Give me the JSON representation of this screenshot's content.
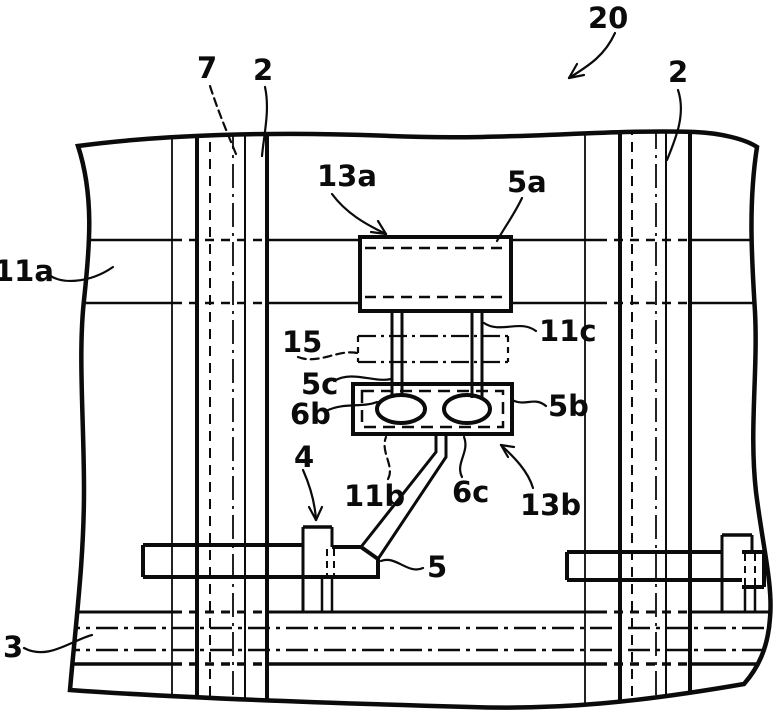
{
  "figure": {
    "kind": "patent-technical-drawing",
    "background_color": "#ffffff",
    "line_color": "#0b0b0b",
    "reference_labels": [
      {
        "text": "20",
        "x": 588,
        "y": 28,
        "leader": "M615,33 C605,55 590,65 569,78",
        "dashed": false,
        "barbs": [
          "M569,78 L584,75",
          "M569,78 L577,64"
        ]
      },
      {
        "text": "7",
        "x": 197,
        "y": 78,
        "leader": "M210,86 C217,108 226,130 236,154",
        "dashed": true,
        "barbs": []
      },
      {
        "text": "2",
        "x": 253,
        "y": 80,
        "leader": "M265,87 C270,110 264,134 262,156",
        "dashed": false,
        "barbs": []
      },
      {
        "text": "2",
        "x": 668,
        "y": 82,
        "leader": "M678,90 C686,114 676,138 667,160",
        "dashed": false,
        "barbs": []
      },
      {
        "text": "13a",
        "x": 317,
        "y": 186,
        "leader": "M332,194 C346,213 365,224 386,234",
        "dashed": false,
        "barbs": [
          "M386,234 L371,232",
          "M386,234 L378,221"
        ]
      },
      {
        "text": "5a",
        "x": 507,
        "y": 192,
        "leader": "M522,198 C514,215 504,228 497,241",
        "dashed": false,
        "barbs": []
      },
      {
        "text": "11a",
        "x": -6,
        "y": 281,
        "leader": "M46,272 C58,286 90,283 113,267",
        "dashed": false,
        "barbs": []
      },
      {
        "text": "15",
        "x": 282,
        "y": 352,
        "leader": "M298,357 C318,365 338,349 357,353",
        "dashed": true,
        "barbs": []
      },
      {
        "text": "11c",
        "x": 539,
        "y": 341,
        "leader": "M536,331 C520,319 500,334 484,323",
        "dashed": false,
        "barbs": []
      },
      {
        "text": "5c",
        "x": 301,
        "y": 394,
        "leader": "M334,381 C352,370 374,383 391,379",
        "dashed": false,
        "barbs": []
      },
      {
        "text": "6b",
        "x": 290,
        "y": 424,
        "leader": "M326,411 C344,402 362,408 377,402",
        "dashed": false,
        "barbs": []
      },
      {
        "text": "5b",
        "x": 548,
        "y": 416,
        "leader": "M546,406 C534,396 526,407 512,400",
        "dashed": false,
        "barbs": []
      },
      {
        "text": "4",
        "x": 294,
        "y": 467,
        "leader": "M303,470 C311,488 315,504 316,520",
        "dashed": false,
        "barbs": [
          "M316,520 L309,507",
          "M316,520 L322,507"
        ]
      },
      {
        "text": "11b",
        "x": 344,
        "y": 506,
        "leader": "M388,479 C395,466 380,452 386,437",
        "dashed": true,
        "barbs": []
      },
      {
        "text": "6c",
        "x": 452,
        "y": 502,
        "leader": "M462,477 C455,463 470,452 464,437",
        "dashed": false,
        "barbs": []
      },
      {
        "text": "13b",
        "x": 520,
        "y": 515,
        "leader": "M533,488 C528,471 514,457 501,445",
        "dashed": false,
        "barbs": [
          "M501,445 L514,447",
          "M501,445 L508,457"
        ]
      },
      {
        "text": "5",
        "x": 427,
        "y": 577,
        "leader": "M423,568 C408,575 396,555 381,561",
        "dashed": false,
        "barbs": []
      },
      {
        "text": "3",
        "x": 3,
        "y": 657,
        "leader": "M24,648 C48,661 72,640 92,635",
        "dashed": false,
        "barbs": []
      }
    ]
  }
}
